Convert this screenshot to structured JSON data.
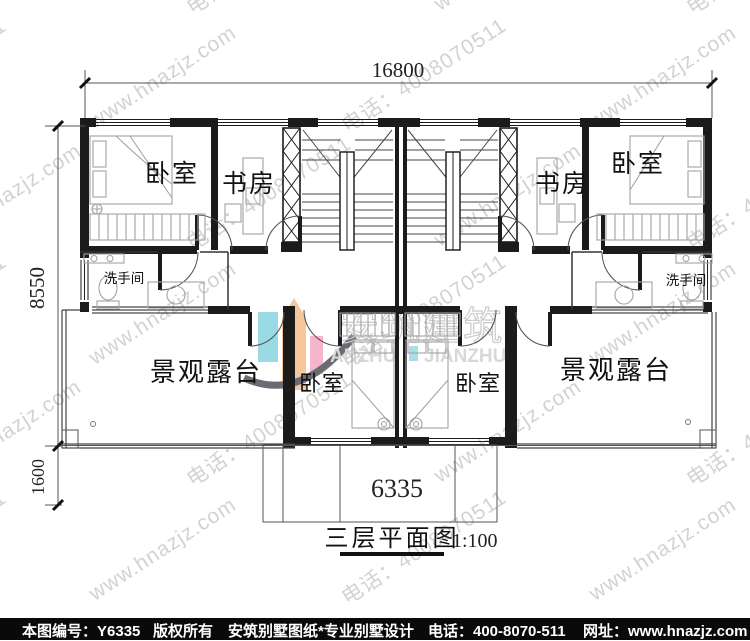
{
  "plan": {
    "title": "三层平面图",
    "scale": "1:100",
    "dimensions": {
      "top": "16800",
      "left_upper": "8550",
      "left_lower": "1600",
      "bottom": "6335"
    },
    "rooms": {
      "bedroom_top_left": "卧室",
      "study_left": "书房",
      "washroom_left": "洗手间",
      "study_right": "书房",
      "bedroom_top_right": "卧室",
      "washroom_right": "洗手间",
      "terrace_left": "景观露台",
      "bedroom_bottom_left": "卧室",
      "bedroom_bottom_right": "卧室",
      "terrace_right": "景观露台"
    }
  },
  "watermark": {
    "site": "www.hnazjz.com",
    "phone": "电话：4008070511",
    "color": "#cbcbcb"
  },
  "brand": {
    "cn": "安筑建筑",
    "en_left": "ANZHU",
    "en_right": "JIANZHU",
    "colors": {
      "teal": "#8fd7e2",
      "orange": "#f4c290",
      "pink": "#f3aec8",
      "swoosh": "#5c5c66"
    }
  },
  "footer": {
    "items": [
      "本图编号：Y6335",
      "版权所有",
      "安筑别墅图纸*专业别墅设计",
      "电话：400-8070-511",
      "网址：www.hnazjz.com"
    ]
  }
}
